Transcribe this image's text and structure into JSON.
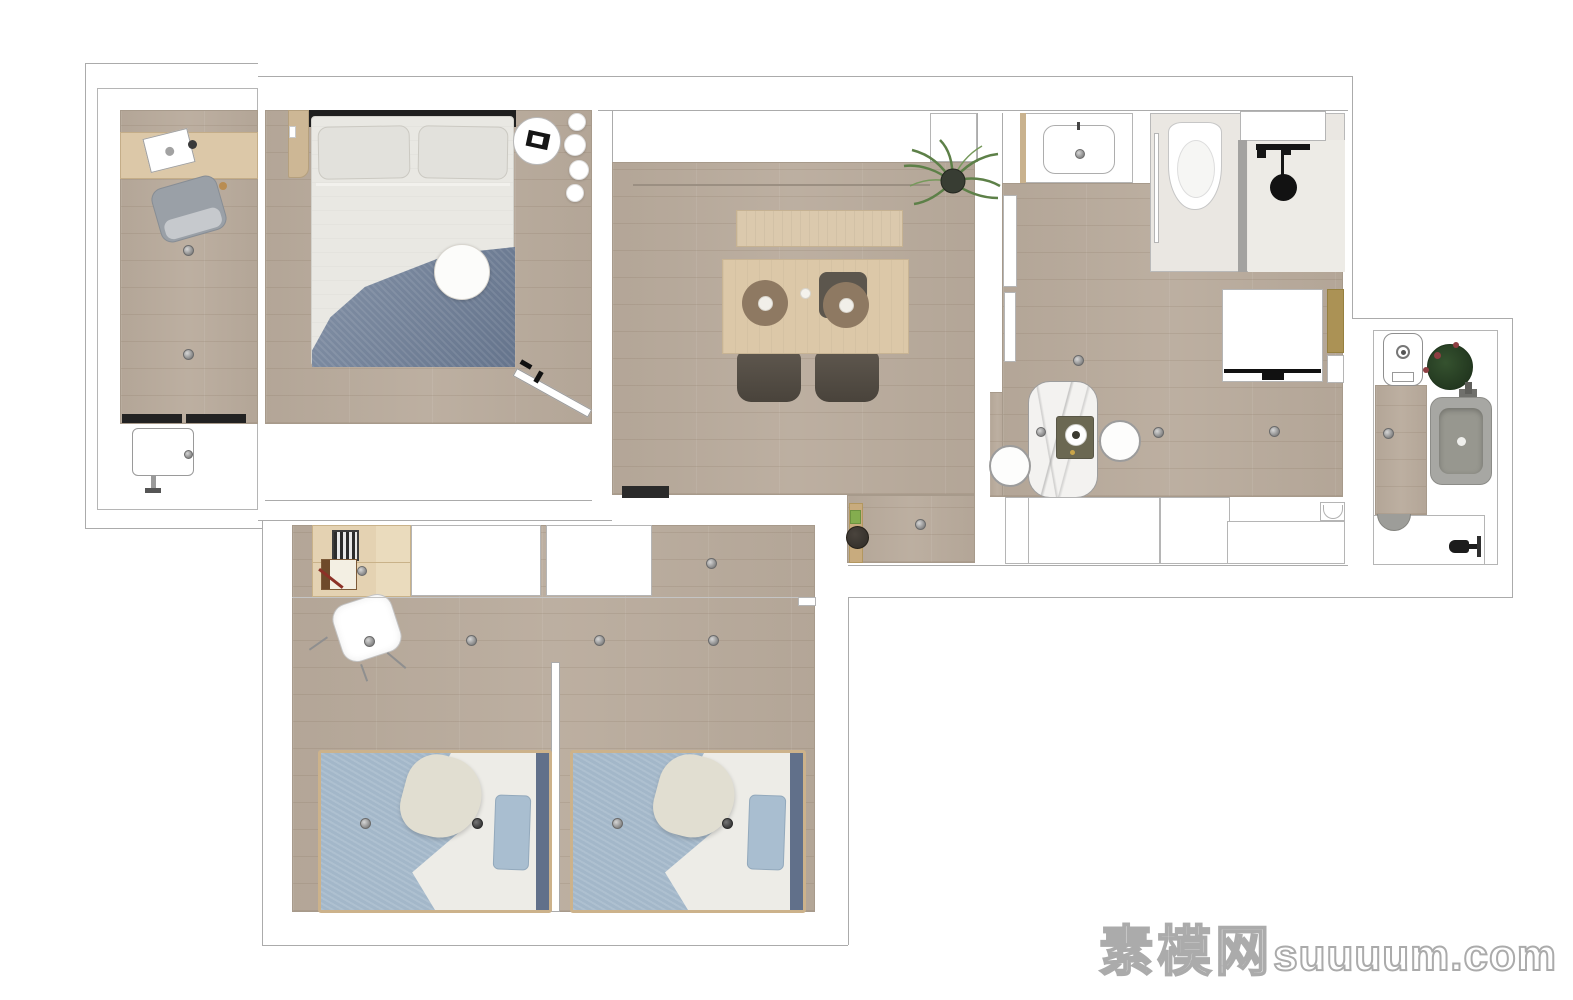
{
  "watermark": {
    "prefix": "素模网",
    "suffix": "suuuum.com"
  },
  "palette": {
    "wall_line": "#ababab",
    "wood": "#b9ab9c",
    "wood_line": "#a79a8b",
    "desk_wood": "#dcc8a8",
    "light_wood": "#e4d2b2",
    "tile": "#eae7e2",
    "tile_light": "#edebe6",
    "marble": "#f3f2f0",
    "duvet": "#a3b7c9",
    "pillow_blue": "#a9bed0",
    "blanket": "#75839a",
    "headboard": "#61708a",
    "bed_frame": "#ccb28b",
    "chair_dark": "#564f46",
    "placemat": "#8e7962",
    "tan_cabinet": "#ab9255",
    "plant": "#5d8048",
    "gray_appliance": "#a7a7a3",
    "black": "#1c1c1c"
  },
  "rooms": [
    {
      "id": "study-balcony",
      "furniture": [
        "desk",
        "laptop",
        "upholstered-chair",
        "cooktop",
        "sink",
        "faucet"
      ]
    },
    {
      "id": "master-bedroom",
      "furniture": [
        "double-bed",
        "pillows",
        "blue-blanket",
        "round-cushion",
        "nightstand",
        "vanity-mirror",
        "curtain",
        "door"
      ]
    },
    {
      "id": "dining-room",
      "furniture": [
        "sideboard",
        "dining-table",
        "placemats",
        "plates",
        "dark-tray",
        "two-chairs",
        "potted-palm",
        "doormat",
        "wall-shelf",
        "bowl"
      ]
    },
    {
      "id": "bathroom",
      "furniture": [
        "washbasin",
        "toilet",
        "glass-partition",
        "divider",
        "shower-set",
        "niche"
      ]
    },
    {
      "id": "living-kitchen",
      "furniture": [
        "tv-cabinet",
        "tv",
        "tall-cabinet",
        "marble-table",
        "induction-cooker",
        "round-stools",
        "base-counters",
        "service-shaft"
      ]
    },
    {
      "id": "laundry-balcony",
      "furniture": [
        "water-heater",
        "plant-pot",
        "wood-mat",
        "laundry-sink",
        "washer-counter",
        "black-tap"
      ]
    },
    {
      "id": "kids-bedroom",
      "furniture": [
        "desk",
        "desk-gadget",
        "open-book",
        "white-chair",
        "wardrobes",
        "partition",
        "single-bed-left",
        "single-bed-right"
      ]
    }
  ]
}
